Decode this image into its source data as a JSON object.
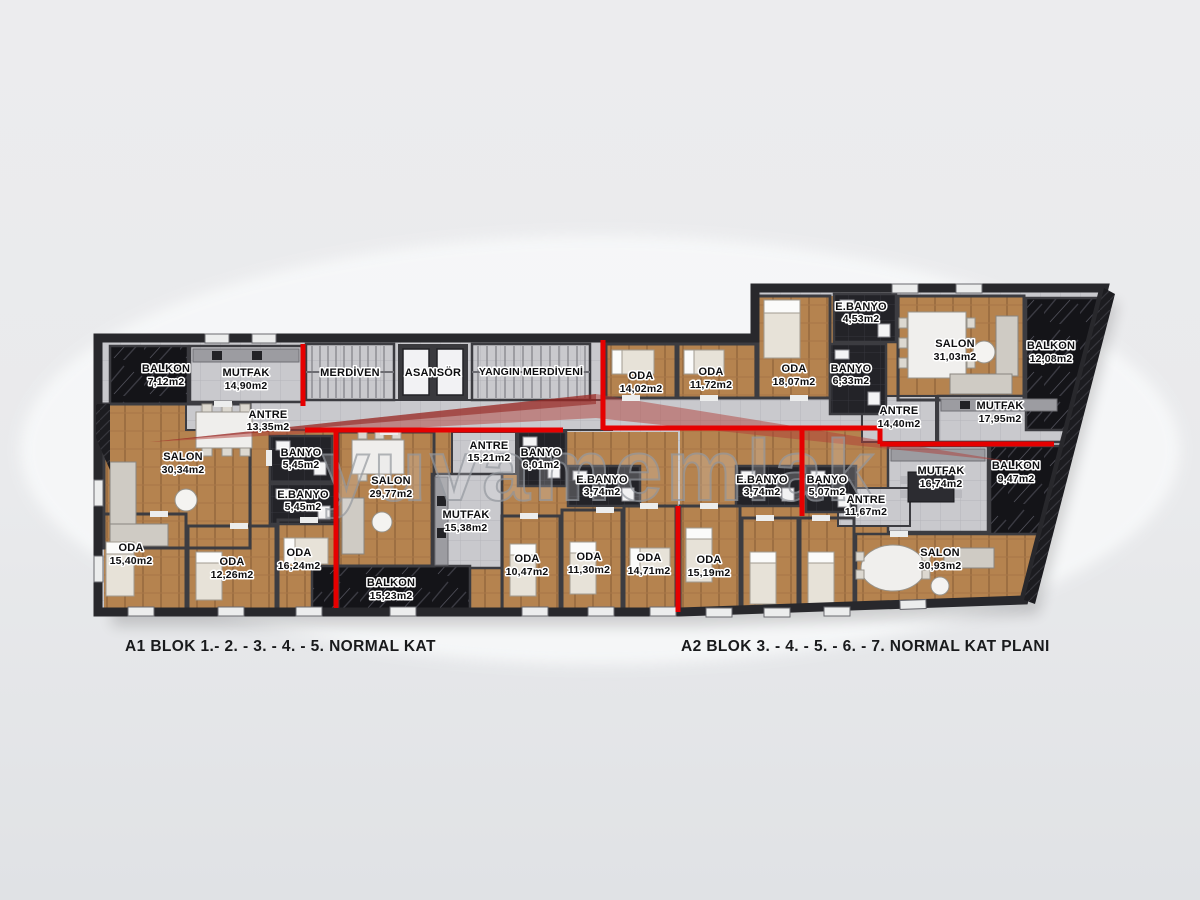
{
  "watermark": {
    "text": "yuvamemlak"
  },
  "captions": {
    "a1": "A1 BLOK 1.- 2. - 3. - 4. - 5. NORMAL KAT",
    "a2": "A2 BLOK 3. - 4. - 5. - 6. - 7. NORMAL KAT PLANI"
  },
  "core": {
    "merdiven": "MERDİVEN",
    "asansor": "ASANSÖR",
    "yangin": "YANGIN MERDİVENİ"
  },
  "colors": {
    "accent_red": "#e60000",
    "wood_floor": "#b5834f",
    "corridor_gray": "#c9c9cd",
    "balcony_marble": "#141418",
    "bathroom_tile": "#232328",
    "wall": "#3c3c41",
    "background": "#e9eaec"
  },
  "rooms": {
    "balkon1": {
      "name": "BALKON",
      "area": "7,12m2"
    },
    "mutfak1": {
      "name": "MUTFAK",
      "area": "14,90m2"
    },
    "antre1": {
      "name": "ANTRE",
      "area": "13,35m2"
    },
    "salon1": {
      "name": "SALON",
      "area": "30,34m2"
    },
    "banyo1": {
      "name": "BANYO",
      "area": "5,45m2"
    },
    "ebanyo1": {
      "name": "E.BANYO",
      "area": "5,45m2"
    },
    "oda1": {
      "name": "ODA",
      "area": "15,40m2"
    },
    "oda2": {
      "name": "ODA",
      "area": "12,26m2"
    },
    "oda3": {
      "name": "ODA",
      "area": "16,24m2"
    },
    "salon2": {
      "name": "SALON",
      "area": "29,77m2"
    },
    "mutfak2": {
      "name": "MUTFAK",
      "area": "15,38m2"
    },
    "balkon2": {
      "name": "BALKON",
      "area": "15,23m2"
    },
    "antre2": {
      "name": "ANTRE",
      "area": "15,21m2"
    },
    "banyo2": {
      "name": "BANYO",
      "area": "6,01m2"
    },
    "ebanyo2": {
      "name": "E.BANYO",
      "area": "3,74m2"
    },
    "oda4": {
      "name": "ODA",
      "area": "10,47m2"
    },
    "oda5": {
      "name": "ODA",
      "area": "11,30m2"
    },
    "oda6": {
      "name": "ODA",
      "area": "14,71m2"
    },
    "oda7": {
      "name": "ODA",
      "area": "14,02m2"
    },
    "oda8": {
      "name": "ODA",
      "area": "11,72m2"
    },
    "oda9": {
      "name": "ODA",
      "area": "18,07m2"
    },
    "ebanyo3": {
      "name": "E.BANYO",
      "area": "4,53m2"
    },
    "banyo3": {
      "name": "BANYO",
      "area": "6,33m2"
    },
    "salon3": {
      "name": "SALON",
      "area": "31,03m2"
    },
    "balkon3": {
      "name": "BALKON",
      "area": "12,08m2"
    },
    "antre3": {
      "name": "ANTRE",
      "area": "14,40m2"
    },
    "mutfak3": {
      "name": "MUTFAK",
      "area": "17,95m2"
    },
    "ebanyo4": {
      "name": "E.BANYO",
      "area": "3,74m2"
    },
    "banyo4": {
      "name": "BANYO",
      "area": "5,07m2"
    },
    "antre4": {
      "name": "ANTRE",
      "area": "11,67m2"
    },
    "mutfak4": {
      "name": "MUTFAK",
      "area": "16,74m2"
    },
    "balkon4": {
      "name": "BALKON",
      "area": "9,47m2"
    },
    "salon4": {
      "name": "SALON",
      "area": "30,93m2"
    },
    "oda10": {
      "name": "ODA",
      "area": "15,19m2"
    }
  }
}
